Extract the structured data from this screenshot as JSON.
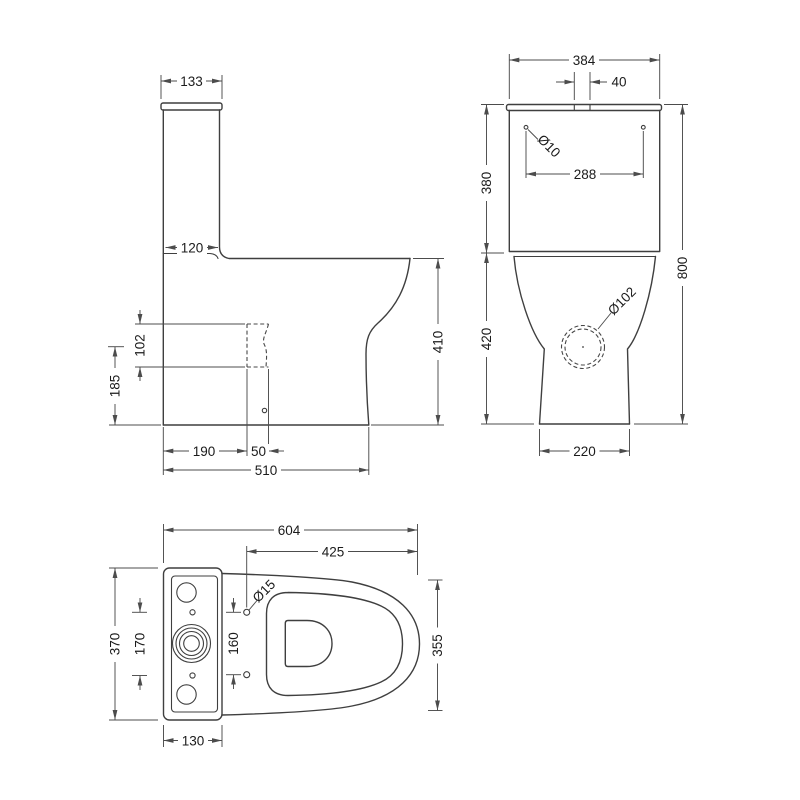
{
  "side_view": {
    "lid_width": "133",
    "cistern_depth": "120",
    "outlet_diameter": "102",
    "outlet_height": "185",
    "outlet_setback": "190",
    "outlet_width": "50",
    "overall_depth": "510",
    "bowl_height": "410"
  },
  "front_view": {
    "cistern_width": "384",
    "button_width": "40",
    "fixing_hole_diameter": "Ø10",
    "fixing_hole_spacing": "288",
    "cistern_height": "380",
    "bowl_height": "420",
    "overall_height": "800",
    "outlet_diameter": "Ø102",
    "base_width": "220"
  },
  "plan_view": {
    "overall_length": "604",
    "bowl_length": "425",
    "seat_hole_diameter": "Ø15",
    "overall_width": "370",
    "cistern_hole_spacing": "170",
    "seat_hole_spacing": "160",
    "bowl_width": "355",
    "cistern_depth": "130"
  },
  "colors": {
    "line": "#3f3f3f",
    "dimension": "#4c4c4c",
    "text": "#1b1b1b",
    "background": "#ffffff"
  }
}
